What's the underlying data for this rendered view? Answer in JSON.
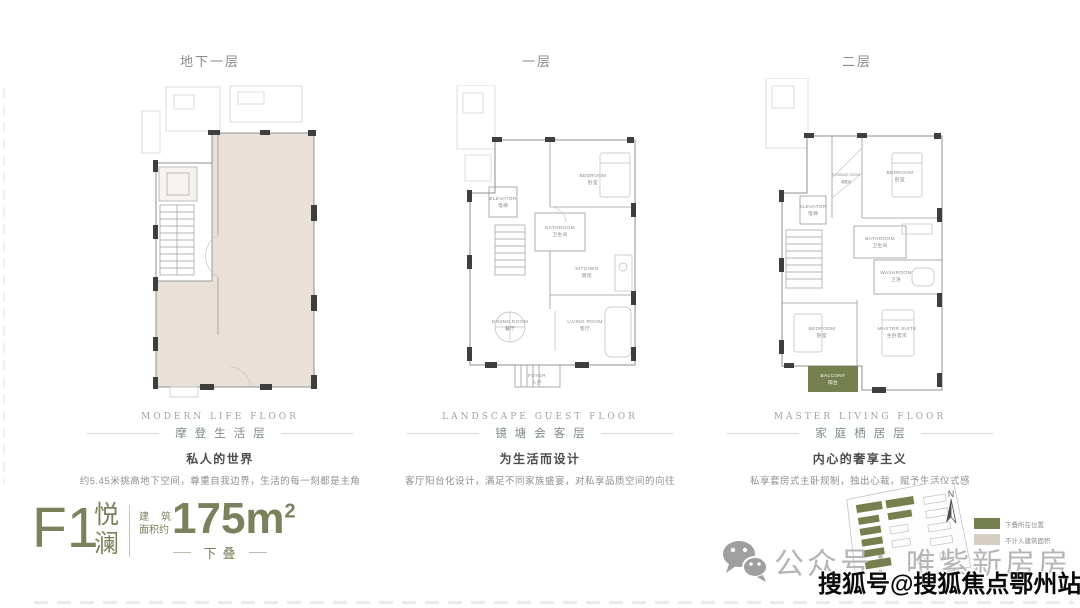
{
  "floors": [
    {
      "header": "地下一层",
      "caption": {
        "en": "MODERN LIFE FLOOR",
        "cn": "摩登生活层",
        "headline": "私人的世界",
        "desc": "约5.45米挑高地下空间，尊重自我边界，生活的每一刻都是主角"
      }
    },
    {
      "header": "一层",
      "caption": {
        "en": "LANDSCAPE GUEST FLOOR",
        "cn": "镜塘会客层",
        "headline": "为生活而设计",
        "desc": "客厅阳台化设计，满足不同家族盛宴，对私享品质空间的向往"
      },
      "rooms": {
        "bedroom": {
          "en": "BEDROOM",
          "cn": "卧室"
        },
        "elevator": {
          "en": "ELEVATOR",
          "cn": "电梯"
        },
        "bathroom": {
          "en": "BATHROOM",
          "cn": "卫生间"
        },
        "kitchen": {
          "en": "KITCHEN",
          "cn": "厨房"
        },
        "dining": {
          "en": "DINING ROOM",
          "cn": "餐厅"
        },
        "living": {
          "en": "LIVING ROOM",
          "cn": "客厅"
        },
        "foyer": {
          "en": "FOYER",
          "cn": "入户"
        }
      }
    },
    {
      "header": "二层",
      "caption": {
        "en": "MASTER LIVING FLOOR",
        "cn": "家庭栖居层",
        "headline": "内心的奢享主义",
        "desc": "私享套房式主卧规制，独出心裁，赋予生活仪式感"
      },
      "rooms": {
        "storage": {
          "en": "STORAGE ROOM",
          "cn": "储藏间"
        },
        "bedroom": {
          "en": "BEDROOM",
          "cn": "卧室"
        },
        "elevator": {
          "en": "ELEVATOR",
          "cn": "电梯"
        },
        "bathroom": {
          "en": "BATHROOM",
          "cn": "卫生间"
        },
        "washroom": {
          "en": "WASHROOM",
          "cn": "卫浴"
        },
        "bedroom2": {
          "en": "BEDROOM",
          "cn": "卧室"
        },
        "master": {
          "en": "MASTER SUITE",
          "cn": "主卧套房"
        },
        "balcony": {
          "en": "BALCONY",
          "cn": "阳台"
        }
      }
    }
  ],
  "unit": {
    "code": "F1",
    "name_top": "悦",
    "name_bottom": "澜",
    "area_label_top": "建筑",
    "area_label_bottom": "面积约",
    "area_value": "175m",
    "area_sup": "2",
    "type": "下叠"
  },
  "legend": {
    "items": [
      {
        "label": "下叠所在位置",
        "color": "#76804e"
      },
      {
        "label": "不计入建筑面积",
        "color": "#d6cdc3"
      }
    ]
  },
  "compass": {
    "label": "N"
  },
  "social": {
    "label": "公众号：唯紫新房房"
  },
  "watermark": {
    "text": "搜狐号@搜狐焦点鄂州站"
  },
  "colors": {
    "accent": "#7a815c",
    "highlight": "#76804e",
    "basement_fill": "#e9e1d8",
    "wall": "#3e3e3e"
  }
}
